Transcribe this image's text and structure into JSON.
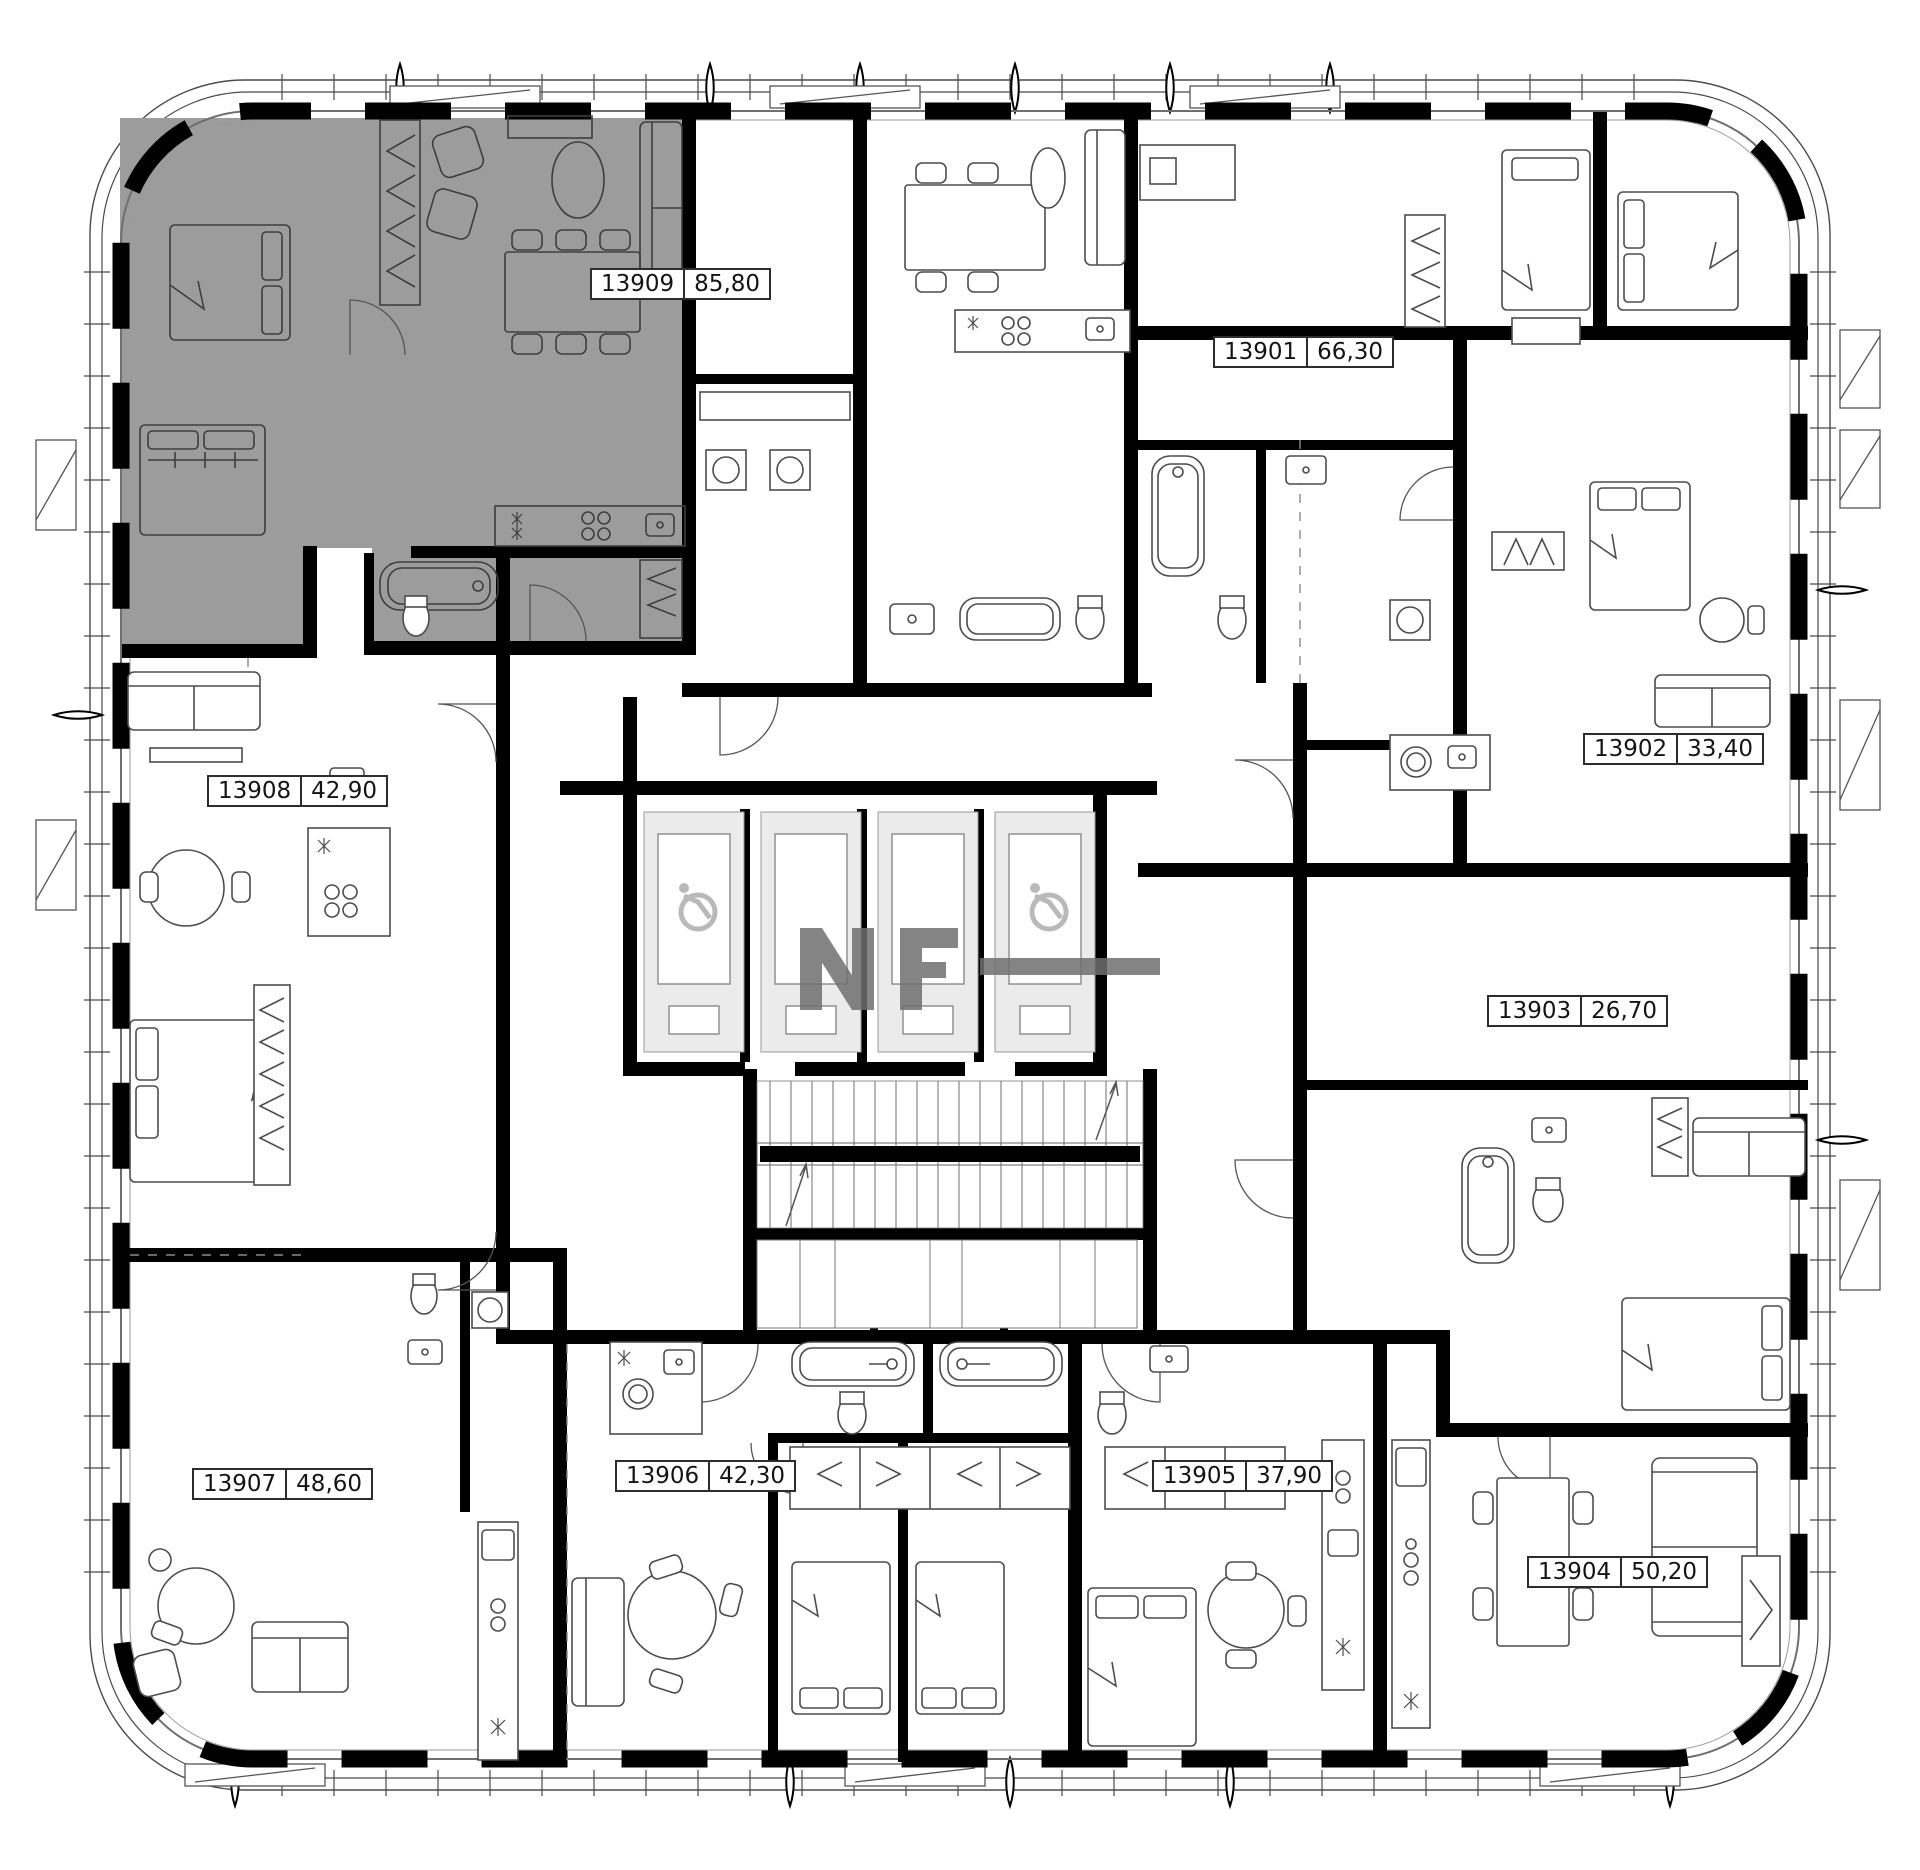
{
  "plan": {
    "watermark": "NF",
    "apartments": [
      {
        "number": "13901",
        "area": "66,30",
        "highlighted": false
      },
      {
        "number": "13902",
        "area": "33,40",
        "highlighted": false
      },
      {
        "number": "13903",
        "area": "26,70",
        "highlighted": false
      },
      {
        "number": "13904",
        "area": "50,20",
        "highlighted": false
      },
      {
        "number": "13905",
        "area": "37,90",
        "highlighted": false
      },
      {
        "number": "13906",
        "area": "42,30",
        "highlighted": false
      },
      {
        "number": "13907",
        "area": "48,60",
        "highlighted": false
      },
      {
        "number": "13908",
        "area": "42,90",
        "highlighted": false
      },
      {
        "number": "13909",
        "area": "85,80",
        "highlighted": true
      }
    ],
    "core": {
      "elevator_count": 4,
      "accessible_elevators": 2,
      "staircase": true
    },
    "colors": {
      "highlight": "#9c9c9c",
      "wall": "#000000",
      "watermark": "#6f6f6f",
      "background": "#ffffff"
    }
  }
}
